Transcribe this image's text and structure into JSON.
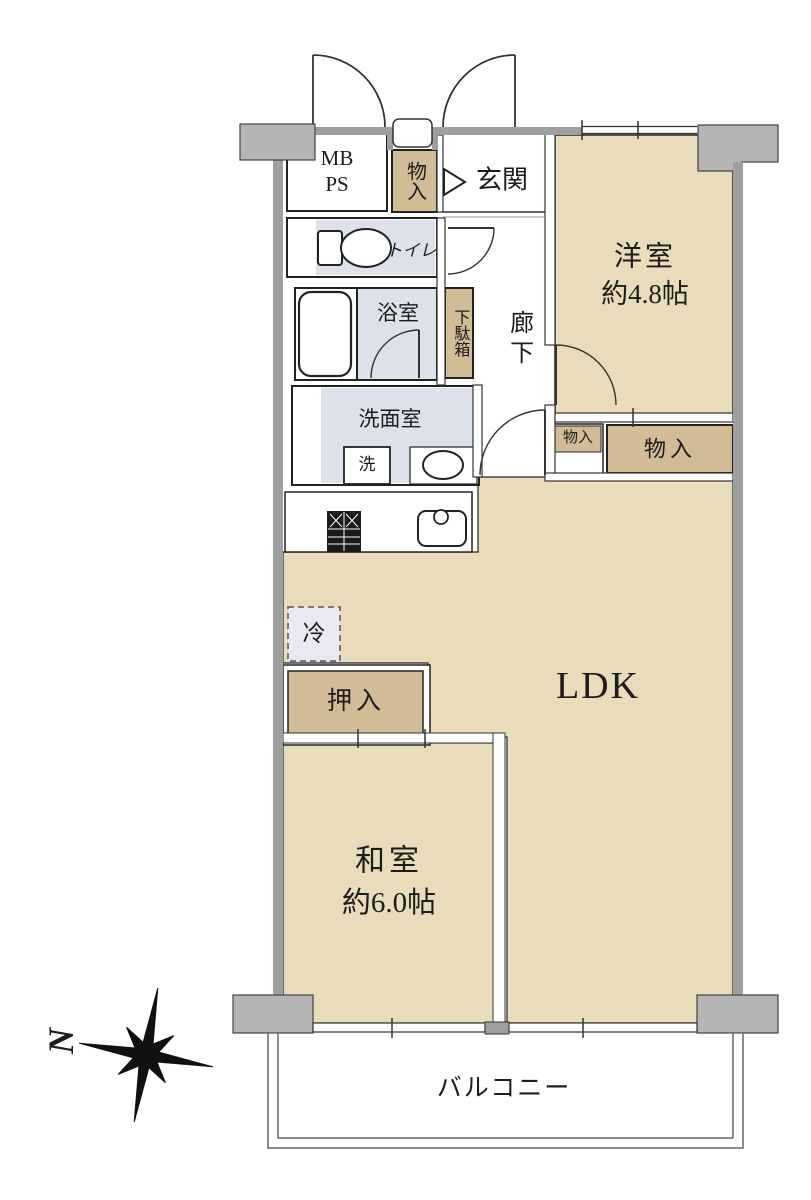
{
  "labels": {
    "mb": "MB",
    "ps": "PS",
    "storage_entrance": "物入",
    "entrance": "玄関",
    "toilet": "トイレ",
    "bathroom": "浴室",
    "shoe_cabinet": "下駄箱",
    "corridor": "廊下",
    "western_room": "洋室",
    "western_room_size": "約4.8帖",
    "washroom": "洗面室",
    "washing_machine": "洗",
    "storage_small": "物入",
    "storage_large": "物入",
    "refrigerator": "冷",
    "ldk": "LDK",
    "closet": "押入",
    "japanese_room": "和室",
    "japanese_room_size": "約6.0帖",
    "balcony": "バルコニー",
    "compass_north": "N"
  },
  "colors": {
    "room_floor": "#e8dcba",
    "closet_fill": "#d1bc96",
    "wet_area": "#dde1ea",
    "fridge_fill": "#e9e9f3",
    "wall": "#9f9f9f",
    "pillar": "#b5b5b5",
    "white": "#ffffff",
    "line": "#222222",
    "background": "#ffffff"
  }
}
